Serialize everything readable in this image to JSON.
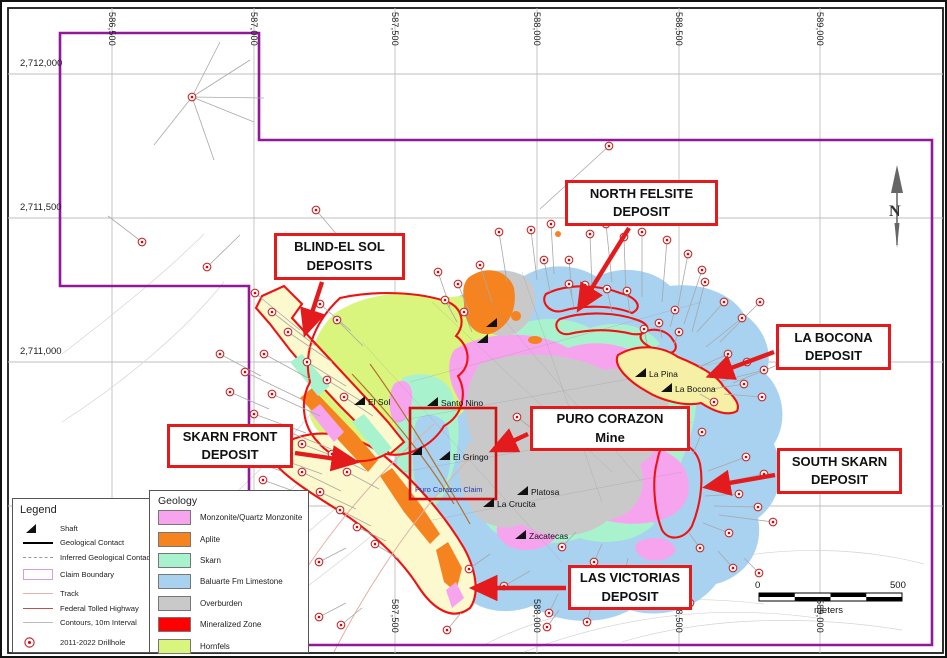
{
  "colors": {
    "monzonite": "#f7a4ee",
    "aplite": "#f5831f",
    "skarn": "#a8f3ce",
    "limestone": "#a9d1f0",
    "overburden": "#c9c9c9",
    "mineralized": "#ee1212",
    "hornfels": "#d9f57d",
    "band_yellow": "#fdf9cf",
    "bocona_yellow": "#f5f0a5",
    "claim_boundary": "#91189b",
    "callout_red": "#e31b1c",
    "drill_red": "#c03030",
    "leader_gray": "#a8a8a8",
    "grid_gray": "#bfbfbf",
    "frame": "#1a1a1a",
    "claim_rect_red": "#d40f0f",
    "claim_text_blue": "#2538a8"
  },
  "map": {
    "north_label": "N",
    "scalebar": {
      "zero": "0",
      "max": "500",
      "unit": "meters"
    },
    "claim_label": "Puro Corazon Claim",
    "axis": {
      "x_labels": [
        {
          "t": "586,500",
          "x": 110
        },
        {
          "t": "587,000",
          "x": 252
        },
        {
          "t": "587,500",
          "x": 393
        },
        {
          "t": "588,000",
          "x": 535
        },
        {
          "t": "588,500",
          "x": 677
        },
        {
          "t": "589,000",
          "x": 818
        }
      ],
      "y_labels": [
        {
          "t": "2,712,000",
          "y": 72
        },
        {
          "t": "2,711,500",
          "y": 216
        },
        {
          "t": "2,711,000",
          "y": 360
        }
      ],
      "y_lines": [
        72,
        216,
        360,
        504
      ],
      "bottom_min_x": 380
    },
    "deposits": [
      {
        "id": "north-felsite",
        "lines": [
          "NORTH FELSITE",
          "DEPOSIT"
        ],
        "box": [
          563,
          178,
          153,
          46
        ],
        "arrow": [
          627,
          226,
          580,
          302
        ]
      },
      {
        "id": "blind-el-sol",
        "lines": [
          "BLIND-EL SOL",
          "DEPOSITS"
        ],
        "box": [
          272,
          231,
          131,
          47
        ],
        "arrow": [
          320,
          280,
          305,
          326
        ]
      },
      {
        "id": "la-bocona",
        "lines": [
          "LA BOCONA",
          "DEPOSIT"
        ],
        "box": [
          774,
          322,
          115,
          46
        ],
        "arrow": [
          772,
          350,
          713,
          372
        ]
      },
      {
        "id": "skarn-front",
        "lines": [
          "SKARN FRONT",
          "DEPOSIT"
        ],
        "box": [
          165,
          422,
          126,
          44
        ],
        "arrow": [
          293,
          451,
          348,
          459
        ]
      },
      {
        "id": "puro-corazon",
        "lines": [
          "PURO CORAZON",
          "Mine"
        ],
        "box": [
          528,
          404,
          160,
          45
        ],
        "arrow": [
          526,
          432,
          496,
          446
        ]
      },
      {
        "id": "south-skarn",
        "lines": [
          "SOUTH SKARN",
          "DEPOSIT"
        ],
        "box": [
          775,
          446,
          125,
          46
        ],
        "arrow": [
          773,
          473,
          710,
          484
        ]
      },
      {
        "id": "las-victorias",
        "lines": [
          "LAS VICTORIAS",
          "DEPOSIT"
        ],
        "box": [
          566,
          563,
          124,
          45
        ],
        "arrow": [
          564,
          586,
          477,
          586
        ]
      }
    ],
    "mines": [
      {
        "name": "Santo Nino",
        "x": 428,
        "y": 397
      },
      {
        "name": "El Sol",
        "x": 355,
        "y": 396
      },
      {
        "name": "El Gringo",
        "x": 440,
        "y": 451
      },
      {
        "name": "Platosa",
        "x": 518,
        "y": 486
      },
      {
        "name": "La Crucita",
        "x": 484,
        "y": 498
      },
      {
        "name": "Zacatecas",
        "x": 516,
        "y": 530
      },
      {
        "name": "La Pina",
        "x": 636,
        "y": 368
      },
      {
        "name": "La Bocona",
        "x": 662,
        "y": 383
      },
      {
        "name": "",
        "x": 412,
        "y": 446
      },
      {
        "name": "",
        "x": 487,
        "y": 318
      },
      {
        "name": "",
        "x": 478,
        "y": 334
      }
    ],
    "legend": {
      "title": "Legend",
      "items": [
        {
          "type": "shaft",
          "label": "Shaft"
        },
        {
          "type": "contact",
          "label": "Geological Contact"
        },
        {
          "type": "inferred",
          "label": "Inferred Geological Contact"
        },
        {
          "type": "claim",
          "label": "Claim Boundary"
        },
        {
          "type": "track",
          "label": "Track"
        },
        {
          "type": "highway",
          "label": "Federal Tolled Highway"
        },
        {
          "type": "contour",
          "label": "Contours, 10m Interval"
        },
        {
          "type": "drillhole",
          "label": "2011-2022 Drillhole"
        }
      ]
    },
    "geology_legend": {
      "title": "Geology",
      "items": [
        {
          "label": "Monzonite/Quartz Monzonite",
          "color": "#f7a4ee"
        },
        {
          "label": "Aplite",
          "color": "#f5831f"
        },
        {
          "label": "Skarn",
          "color": "#a8f3ce"
        },
        {
          "label": "Baluarte Fm Limestone",
          "color": "#a9d1f0"
        },
        {
          "label": "Overburden",
          "color": "#c9c9c9"
        },
        {
          "label": "Mineralized Zone",
          "color": "#ff0000"
        },
        {
          "label": "Hornfels",
          "color": "#d9f57d"
        }
      ]
    },
    "fan_lines": [
      [
        190,
        95,
        248,
        58
      ],
      [
        190,
        95,
        252,
        120
      ],
      [
        190,
        95,
        152,
        143
      ],
      [
        190,
        95,
        262,
        96
      ],
      [
        190,
        95,
        218,
        40
      ]
    ],
    "drillholes": [
      [
        190,
        95,
        212,
        158
      ],
      [
        140,
        240,
        106,
        214
      ],
      [
        205,
        265,
        238,
        233
      ],
      [
        314,
        208,
        348,
        248
      ],
      [
        607,
        144,
        538,
        207
      ],
      [
        436,
        270,
        448,
        305
      ],
      [
        443,
        298,
        455,
        320
      ],
      [
        462,
        310,
        470,
        330
      ],
      [
        456,
        282,
        468,
        312
      ],
      [
        478,
        263,
        490,
        300
      ],
      [
        497,
        230,
        505,
        280
      ],
      [
        529,
        228,
        535,
        278
      ],
      [
        549,
        222,
        552,
        272
      ],
      [
        542,
        258,
        548,
        290
      ],
      [
        567,
        258,
        570,
        295
      ],
      [
        567,
        282,
        572,
        305
      ],
      [
        588,
        232,
        590,
        285
      ],
      [
        605,
        287,
        610,
        310
      ],
      [
        604,
        222,
        610,
        280
      ],
      [
        625,
        289,
        628,
        312
      ],
      [
        622,
        235,
        624,
        295
      ],
      [
        640,
        230,
        640,
        295
      ],
      [
        642,
        327,
        645,
        342
      ],
      [
        657,
        321,
        660,
        336
      ],
      [
        665,
        238,
        660,
        300
      ],
      [
        673,
        308,
        668,
        325
      ],
      [
        677,
        330,
        672,
        342
      ],
      [
        686,
        252,
        675,
        310
      ],
      [
        700,
        268,
        682,
        322
      ],
      [
        703,
        280,
        690,
        330
      ],
      [
        722,
        300,
        695,
        330
      ],
      [
        740,
        316,
        704,
        345
      ],
      [
        758,
        300,
        718,
        340
      ],
      [
        726,
        352,
        697,
        365
      ],
      [
        745,
        360,
        707,
        373
      ],
      [
        762,
        368,
        720,
        379
      ],
      [
        778,
        362,
        731,
        381
      ],
      [
        742,
        382,
        710,
        387
      ],
      [
        760,
        395,
        722,
        392
      ],
      [
        712,
        400,
        698,
        392
      ],
      [
        700,
        430,
        691,
        452
      ],
      [
        744,
        455,
        706,
        469
      ],
      [
        762,
        472,
        714,
        482
      ],
      [
        737,
        492,
        703,
        494
      ],
      [
        756,
        505,
        712,
        504
      ],
      [
        771,
        520,
        717,
        513
      ],
      [
        727,
        531,
        701,
        521
      ],
      [
        698,
        546,
        687,
        531
      ],
      [
        467,
        567,
        488,
        552
      ],
      [
        502,
        584,
        528,
        569
      ],
      [
        560,
        545,
        574,
        530
      ],
      [
        592,
        560,
        600,
        542
      ],
      [
        622,
        575,
        626,
        556
      ],
      [
        655,
        591,
        651,
        570
      ],
      [
        688,
        601,
        676,
        580
      ],
      [
        731,
        566,
        716,
        549
      ],
      [
        757,
        571,
        742,
        556
      ],
      [
        547,
        611,
        556,
        592
      ],
      [
        585,
        620,
        590,
        602
      ],
      [
        339,
        623,
        360,
        606
      ],
      [
        445,
        628,
        459,
        611
      ],
      [
        545,
        625,
        557,
        608
      ],
      [
        253,
        291,
        298,
        328
      ],
      [
        270,
        310,
        314,
        344
      ],
      [
        286,
        330,
        330,
        360
      ],
      [
        262,
        352,
        308,
        377
      ],
      [
        243,
        370,
        299,
        397
      ],
      [
        270,
        392,
        318,
        414
      ],
      [
        252,
        412,
        304,
        431
      ],
      [
        282,
        428,
        329,
        447
      ],
      [
        300,
        442,
        344,
        459
      ],
      [
        318,
        302,
        349,
        329
      ],
      [
        335,
        318,
        361,
        344
      ],
      [
        305,
        360,
        344,
        384
      ],
      [
        325,
        378,
        359,
        399
      ],
      [
        342,
        395,
        371,
        414
      ],
      [
        330,
        452,
        364,
        469
      ],
      [
        345,
        470,
        377,
        487
      ],
      [
        300,
        470,
        339,
        489
      ],
      [
        318,
        490,
        354,
        507
      ],
      [
        338,
        508,
        369,
        524
      ],
      [
        355,
        525,
        384,
        539
      ],
      [
        373,
        542,
        397,
        557
      ],
      [
        218,
        352,
        259,
        374
      ],
      [
        228,
        390,
        267,
        407
      ],
      [
        212,
        430,
        254,
        447
      ],
      [
        240,
        455,
        279,
        469
      ],
      [
        261,
        478,
        297,
        491
      ],
      [
        287,
        460,
        320,
        472
      ],
      [
        317,
        560,
        344,
        546
      ],
      [
        317,
        615,
        344,
        601
      ],
      [
        515,
        415,
        532,
        428
      ],
      [
        583,
        283,
        588,
        300
      ]
    ]
  }
}
